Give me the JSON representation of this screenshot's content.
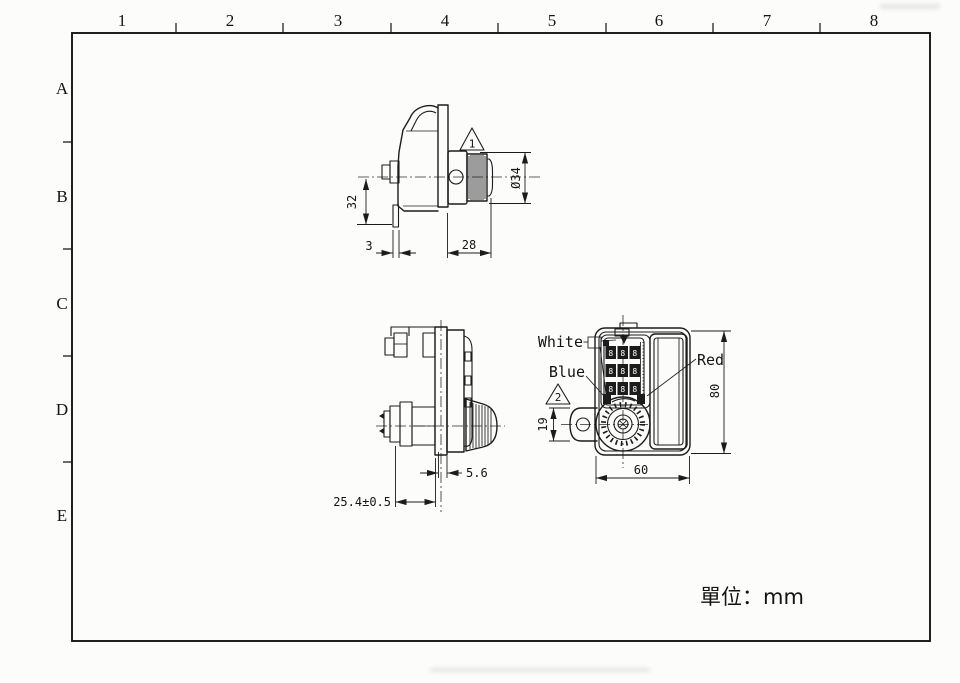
{
  "sheet": {
    "unit_label": "單位：mm",
    "grid_columns": [
      "1",
      "2",
      "3",
      "4",
      "5",
      "6",
      "7",
      "8"
    ],
    "grid_rows": [
      "A",
      "B",
      "C",
      "D",
      "E"
    ]
  },
  "top_view": {
    "dim_height": "32",
    "dim_latch_thickness": "3",
    "dim_depth": "28",
    "dim_dial_diameter": "Ø34",
    "note_flag": "1"
  },
  "side_view": {
    "dim_flange_offset": "5.6",
    "dim_mount_depth": "25.4±0.5"
  },
  "front_view": {
    "label_white": "White",
    "label_blue": "Blue",
    "label_red": "Red",
    "note_flag": "2",
    "dim_tab_height": "19",
    "dim_body_height": "80",
    "dim_body_width": "60",
    "wheel_digits": [
      [
        "8",
        "8",
        "8"
      ],
      [
        "8",
        "8",
        "8"
      ],
      [
        "8",
        "8",
        "8"
      ]
    ]
  }
}
